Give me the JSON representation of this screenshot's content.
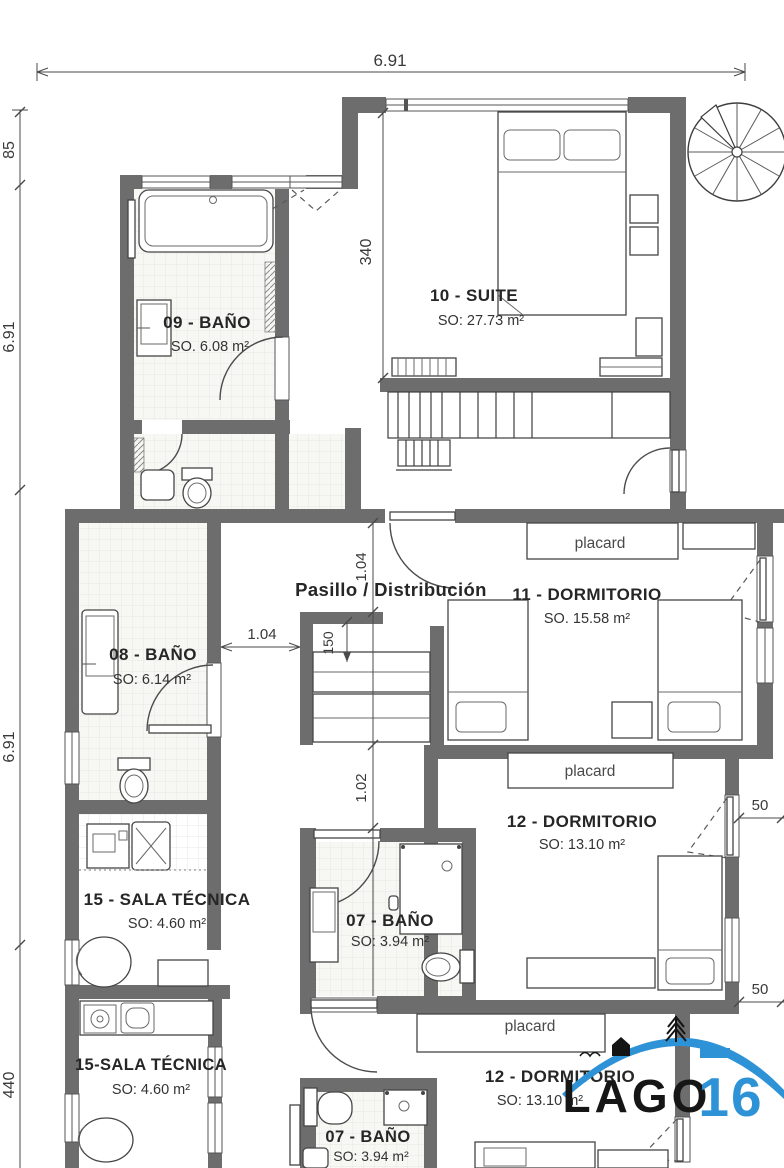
{
  "plan_title": "Planta - Lago 16",
  "rooms": {
    "bano09": {
      "label": "09 - BAÑO",
      "area": "SO. 6.08 m²"
    },
    "suite10": {
      "label": "10 - SUITE",
      "area": "SO: 27.73 m²"
    },
    "bano08": {
      "label": "08 - BAÑO",
      "area": "SO: 6.14 m²"
    },
    "pasillo": {
      "label": "Pasillo / Distribución"
    },
    "dorm11": {
      "label": "11 - DORMITORIO",
      "area": "SO. 15.58 m²"
    },
    "dorm12": {
      "label": "12 - DORMITORIO",
      "area": "SO: 13.10 m²"
    },
    "sala15": {
      "label": "15 - SALA TÉCNICA",
      "area": "SO: 4.60 m²"
    },
    "bano07": {
      "label": "07 - BAÑO",
      "area": "SO: 3.94 m²"
    },
    "sala15b": {
      "label": "15-SALA TÉCNICA",
      "area": "SO: 4.60 m²"
    },
    "dorm12b": {
      "label": "12 - DORMITORIO",
      "area": "SO: 13.10 m²"
    },
    "bano07b": {
      "label": "07 - BAÑO",
      "area": "SO: 3.94 m²"
    }
  },
  "closets": {
    "placard1": "placard",
    "placard2": "placard",
    "placard3": "placard"
  },
  "dimensions": {
    "top_width": "6.91",
    "left_top": "85",
    "left_mid": "6.91",
    "left_lower": "6.91",
    "left_bottom": "440",
    "suite_depth": "340",
    "hall_width": "1.04",
    "hall_width_v": "1.04",
    "hall_width_v2": "1.02",
    "closet_depth": "150",
    "offset_a": "50",
    "offset_b": "50"
  },
  "logo": {
    "name": "LAGO",
    "number": "16"
  },
  "colors": {
    "wall": "#6d6d6d",
    "logo_blue": "#2e93d6",
    "ink": "#262626"
  }
}
